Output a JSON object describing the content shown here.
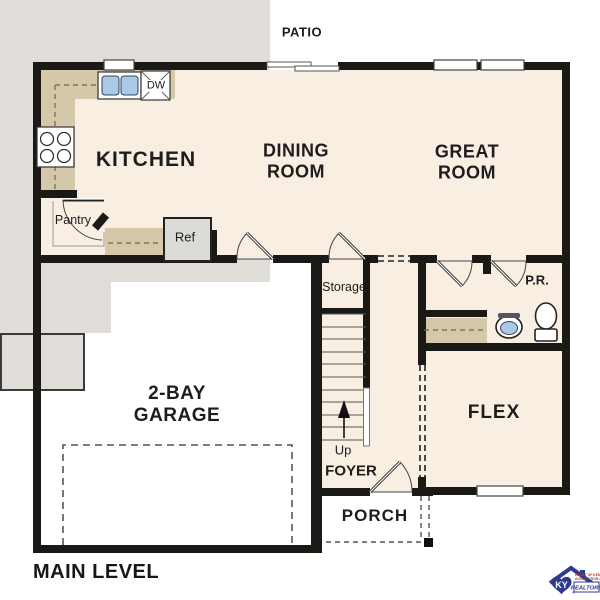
{
  "plan_title": "MAIN LEVEL",
  "rooms": {
    "patio": "PATIO",
    "kitchen": "KITCHEN",
    "dining_room": [
      "DINING",
      "ROOM"
    ],
    "great_room": [
      "GREAT",
      "ROOM"
    ],
    "garage": [
      "2-BAY",
      "GARAGE"
    ],
    "flex": "FLEX",
    "foyer": "FOYER",
    "porch": "PORCH",
    "storage": "Storage",
    "pantry": "Pantry",
    "powder_room": "P.R."
  },
  "fixtures": {
    "dishwasher": "DW",
    "refrigerator": "Ref",
    "stairs_up": "Up"
  },
  "logo": {
    "monogram": "KY",
    "line1": "HEART OF KENTUCKY",
    "line2": "ASSOCIATION OF",
    "line3": "REALTORS",
    "reg": "®"
  },
  "colors": {
    "floor": "#f8eee2",
    "hard": "#e0ddd9",
    "patio": "#e5e3e0",
    "counter": "#d5c8a8",
    "wall": "#1b1916",
    "line": "#4a4a4a",
    "blue": "#aac9e6",
    "logoblue": "#2e3b8d",
    "logored": "#b03a34"
  }
}
